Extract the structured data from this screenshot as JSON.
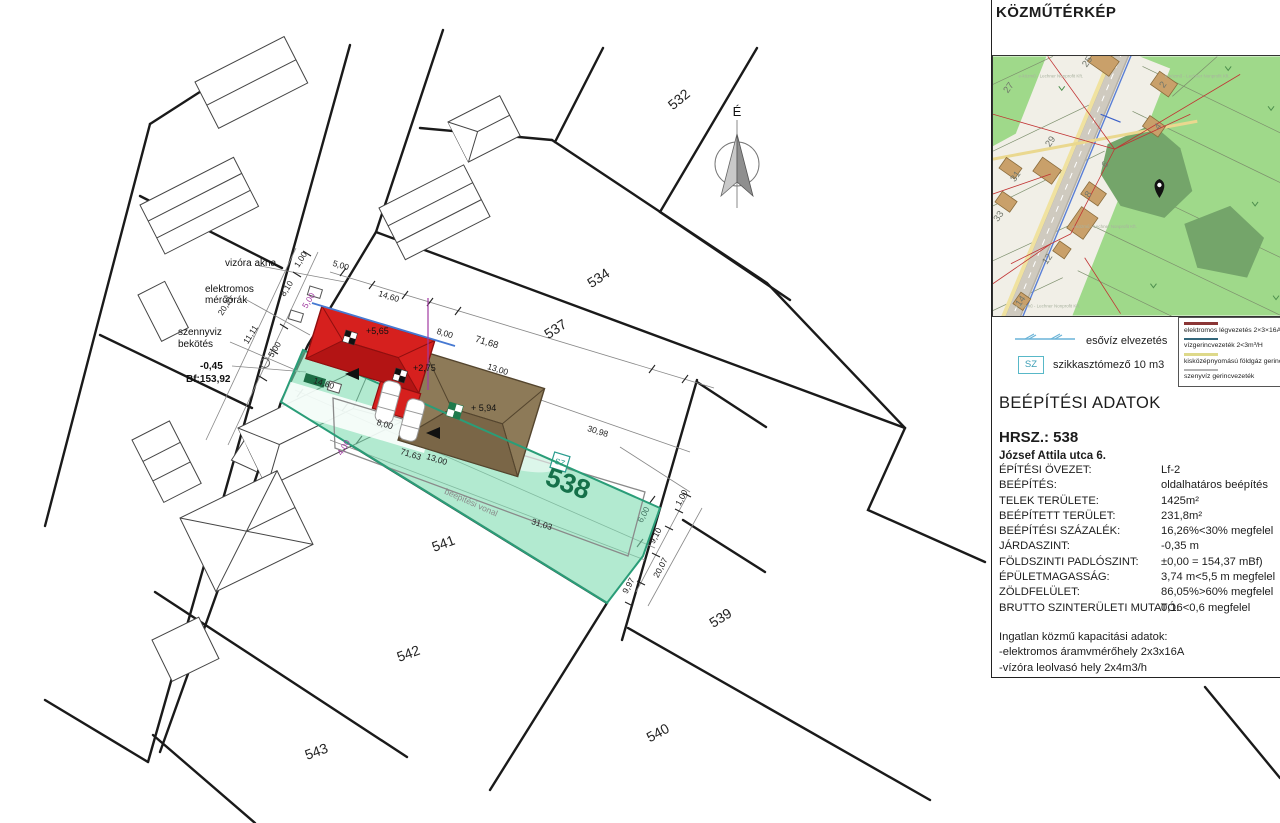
{
  "panel": {
    "title": "KÖZMŰTÉRKÉP",
    "legend_rain_label": "esővíz elvezetés",
    "legend_sz_symbol": "SZ",
    "legend_sz_label": "szikkasztómező 10 m3",
    "legend_box_items": [
      {
        "label": "elektromos légvezetés 2×3×16A",
        "color": "#8b3636"
      },
      {
        "label": "vízgerincvezeték 2<3m³/H",
        "color": "#33667a"
      },
      {
        "label": "kisközépnyomású földgáz gerincvezeték",
        "color": "#ded98a"
      },
      {
        "label": "szenyvíz gerincvezeték",
        "color": "#b3b3b3"
      }
    ],
    "data_heading": "BEÉPÍTÉSI ADATOK",
    "hrsz": "HRSZ.: 538",
    "address": "József Attila utca 6.",
    "rows": [
      {
        "label": "ÉPÍTÉSI ÖVEZET:",
        "value": "Lf-2"
      },
      {
        "label": "BEÉPÍTÉS:",
        "value": "oldalhatáros beépítés"
      },
      {
        "label": "TELEK TERÜLETE:",
        "value": "1425m²"
      },
      {
        "label": "BEÉPÍTETT TERÜLET:",
        "value": "231,8m²"
      },
      {
        "label": "BEÉPÍTÉSI SZÁZALÉK:",
        "value": "16,26%<30% megfelel"
      },
      {
        "label": "JÁRDASZINT:",
        "value": "-0,35 m"
      },
      {
        "label": "FÖLDSZINTI PADLÓSZINT:",
        "value": "±0,00 = 154,37 mBf)"
      },
      {
        "label": "ÉPÜLETMAGASSÁG:",
        "value": "3,74 m<5,5 m megfelel"
      },
      {
        "label": "ZÖLDFELÜLET:",
        "value": "86,05%>60% megfelel"
      },
      {
        "label": "BRUTTO SZINTERÜLETI MUTATÓ:",
        "value": "0,16<0,6 megfelel"
      }
    ],
    "capacity_heading": "Ingatlan közmű kapacitási adatok:",
    "capacity_lines": [
      "-elektromos áramvmérőhely 2x3x16A",
      "-vízóra leolvasó hely 2x4m3/h"
    ]
  },
  "map": {
    "watermark": "e-közmű - Lechner Nonprofit Kft.",
    "watermarks": [
      {
        "x": 58,
        "y": 21
      },
      {
        "x": 205,
        "y": 21
      },
      {
        "x": 112,
        "y": 172
      },
      {
        "x": 55,
        "y": 252
      }
    ],
    "house_numbers": [
      {
        "t": "25",
        "x": 97,
        "y": 7
      },
      {
        "t": "27",
        "x": 18,
        "y": 33
      },
      {
        "t": "2",
        "x": 173,
        "y": 30
      },
      {
        "t": "4",
        "x": 168,
        "y": 72
      },
      {
        "t": "29",
        "x": 60,
        "y": 87
      },
      {
        "t": "6",
        "x": 115,
        "y": 110
      },
      {
        "t": "31",
        "x": 25,
        "y": 122
      },
      {
        "t": "8",
        "x": 98,
        "y": 140
      },
      {
        "t": "33",
        "x": 8,
        "y": 162
      },
      {
        "t": "12",
        "x": 57,
        "y": 205
      },
      {
        "t": "14",
        "x": 30,
        "y": 247
      }
    ],
    "colors": {
      "grass": "#9fd98a",
      "trees": "#74a56a",
      "plot": "#f1efe7",
      "road": "#cfcabf",
      "building": "#c9a06a",
      "powerline": "#c13333"
    }
  },
  "site_plan": {
    "north_label": "É",
    "sz_symbol": "SZ",
    "accent_colors": {
      "plot_fill": "#7fdcb0",
      "plot_edge": "#2a9d78",
      "new_building": "#d6201e",
      "old_building": "#8d7a58",
      "purple": "#a23ba2",
      "blue_line": "#4679d2"
    },
    "plot_labels": [
      {
        "t": "532",
        "x": 682,
        "y": 103,
        "r": -40,
        "s": 14
      },
      {
        "t": "534",
        "x": 601,
        "y": 282,
        "r": -33,
        "s": 14
      },
      {
        "t": "537",
        "x": 558,
        "y": 333,
        "r": -33,
        "s": 14
      },
      {
        "t": "538",
        "x": 565,
        "y": 492,
        "r": 20,
        "s": 27,
        "c": "#15714a",
        "b": 1
      },
      {
        "t": "541",
        "x": 445,
        "y": 548,
        "r": -20,
        "s": 14
      },
      {
        "t": "542",
        "x": 410,
        "y": 658,
        "r": -20,
        "s": 14
      },
      {
        "t": "539",
        "x": 723,
        "y": 622,
        "r": -32,
        "s": 14
      },
      {
        "t": "540",
        "x": 660,
        "y": 737,
        "r": -28,
        "s": 14
      },
      {
        "t": "543",
        "x": 318,
        "y": 756,
        "r": -20,
        "s": 14
      }
    ],
    "dimensions": [
      {
        "t": "5,00",
        "x": 340,
        "y": 268,
        "r": 17
      },
      {
        "t": "14,60",
        "x": 388,
        "y": 299,
        "r": 17
      },
      {
        "t": "8,00",
        "x": 444,
        "y": 336,
        "r": 17
      },
      {
        "t": "71,68",
        "x": 486,
        "y": 345,
        "r": 17,
        "s": 9.5
      },
      {
        "t": "13,00",
        "x": 497,
        "y": 372,
        "r": 17
      },
      {
        "t": "30,98",
        "x": 597,
        "y": 434,
        "r": 17
      },
      {
        "t": "14,60",
        "x": 323,
        "y": 386,
        "r": 17
      },
      {
        "t": "8,00",
        "x": 384,
        "y": 427,
        "r": 17
      },
      {
        "t": "71,63",
        "x": 410,
        "y": 457,
        "r": 17
      },
      {
        "t": "13,00",
        "x": 436,
        "y": 462,
        "r": 17
      },
      {
        "t": "31,03",
        "x": 541,
        "y": 527,
        "r": 17
      },
      {
        "t": "1,00",
        "x": 303,
        "y": 261,
        "r": -58
      },
      {
        "t": "8,10",
        "x": 289,
        "y": 290,
        "r": -58
      },
      {
        "t": "20,21",
        "x": 228,
        "y": 307,
        "r": -58
      },
      {
        "t": "11,11",
        "x": 253,
        "y": 336,
        "r": -58
      },
      {
        "t": "5,00",
        "x": 311,
        "y": 302,
        "r": -58,
        "c": "#a23ba2"
      },
      {
        "t": "5,00",
        "x": 277,
        "y": 351,
        "r": -58
      },
      {
        "t": "4,00",
        "x": 346,
        "y": 449,
        "r": -58,
        "c": "#a23ba2"
      },
      {
        "t": "1,00",
        "x": 684,
        "y": 499,
        "r": -62
      },
      {
        "t": "6,00",
        "x": 646,
        "y": 516,
        "r": -62,
        "c": "#4a7a68"
      },
      {
        "t": "9,10",
        "x": 658,
        "y": 537,
        "r": -62
      },
      {
        "t": "20,07",
        "x": 663,
        "y": 569,
        "r": -62
      },
      {
        "t": "9,97",
        "x": 631,
        "y": 587,
        "r": -62
      }
    ],
    "annotations": [
      {
        "t": "vizóra akna",
        "x": 225,
        "y": 266
      },
      {
        "t": "elektromos",
        "x": 205,
        "y": 292
      },
      {
        "t": "mérőórák",
        "x": 205,
        "y": 303
      },
      {
        "t": "szennyviz",
        "x": 178,
        "y": 335
      },
      {
        "t": "bekötés",
        "x": 178,
        "y": 347
      },
      {
        "t": "-0,45",
        "x": 200,
        "y": 369,
        "b": 1
      },
      {
        "t": "Bf:153,92",
        "x": 186,
        "y": 382,
        "b": 1
      }
    ],
    "height_markers": [
      {
        "t": "+5,65",
        "x": 366,
        "y": 334
      },
      {
        "t": "+2,75",
        "x": 413,
        "y": 371
      },
      {
        "t": "+ 5,94",
        "x": 471,
        "y": 411
      }
    ],
    "building_line_label": {
      "t": "beépítési vonal",
      "x": 470,
      "y": 505,
      "r": 24
    }
  }
}
